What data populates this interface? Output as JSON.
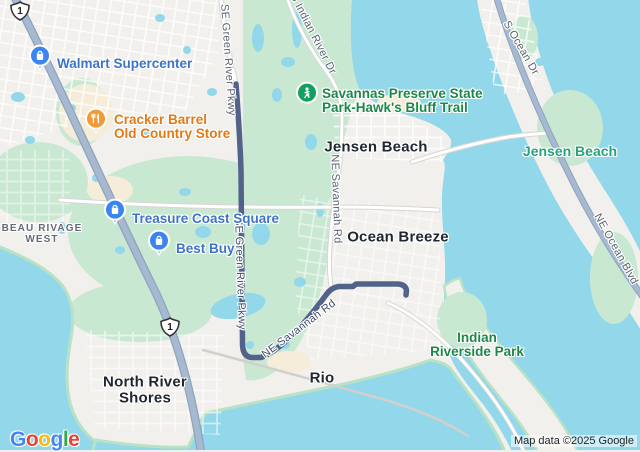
{
  "colors": {
    "land": "#f2f0ec",
    "water": "#92d8ea",
    "park": "#c9e8d2",
    "parkFringe": "#b9e2c4",
    "sand": "#f5edda",
    "route": "#53628a",
    "highway": "#a6b9d1",
    "highwayCasing": "#8ea3bd",
    "minorCasing": "#d8d6d2",
    "poiBlue": "#3d74c8",
    "poiOrange": "#e07a17",
    "pinBlue": "#3b85f0",
    "pinOrange": "#f29a38",
    "pinGreen": "#12a05f",
    "parkText": "#1d8649",
    "tealText": "#28a17c",
    "locality": "#202730",
    "neighborhood": "#636b78",
    "roadLabel": "#5b6370",
    "routeLabel": "#414e6d"
  },
  "pois": [
    {
      "label": "Walmart Supercenter",
      "type": "shopping"
    },
    {
      "label": "Cracker Barrel",
      "label2": "Old Country Store",
      "type": "restaurant"
    },
    {
      "label": "Treasure Coast Square",
      "type": "shopping"
    },
    {
      "label": "Best Buy",
      "type": "shopping"
    },
    {
      "label": "Savannas Preserve State",
      "label2": "Park-Hawk's Bluff Trail",
      "type": "park-trail"
    },
    {
      "label": "Indian",
      "label2": "Riverside Park",
      "type": "park"
    }
  ],
  "localities": [
    {
      "name": "Jensen Beach"
    },
    {
      "name": "Jensen Beach"
    },
    {
      "name": "Ocean Breeze"
    },
    {
      "name": "Rio"
    },
    {
      "name": "North River",
      "name2": "Shores"
    },
    {
      "name": "BEAU RIVAGE",
      "name2": "WEST"
    }
  ],
  "roads": [
    {
      "name": "SE Green River Pkwy"
    },
    {
      "name": "SE Green River Pkwy"
    },
    {
      "name": "NE Savannah Rd"
    },
    {
      "name": "NE Savannah Rd"
    },
    {
      "name": "S Indian River Dr"
    },
    {
      "name": "S Ocean Dr"
    },
    {
      "name": "NE Ocean Blvd"
    },
    {
      "shield": "1"
    },
    {
      "shield": "1"
    }
  ],
  "footer": {
    "logo": [
      "G",
      "o",
      "o",
      "g",
      "l",
      "e"
    ],
    "logo_colors": [
      "#4285F4",
      "#EA4335",
      "#FBBC05",
      "#4285F4",
      "#34A853",
      "#EA4335"
    ],
    "attribution": "Map data ©2025 Google"
  }
}
